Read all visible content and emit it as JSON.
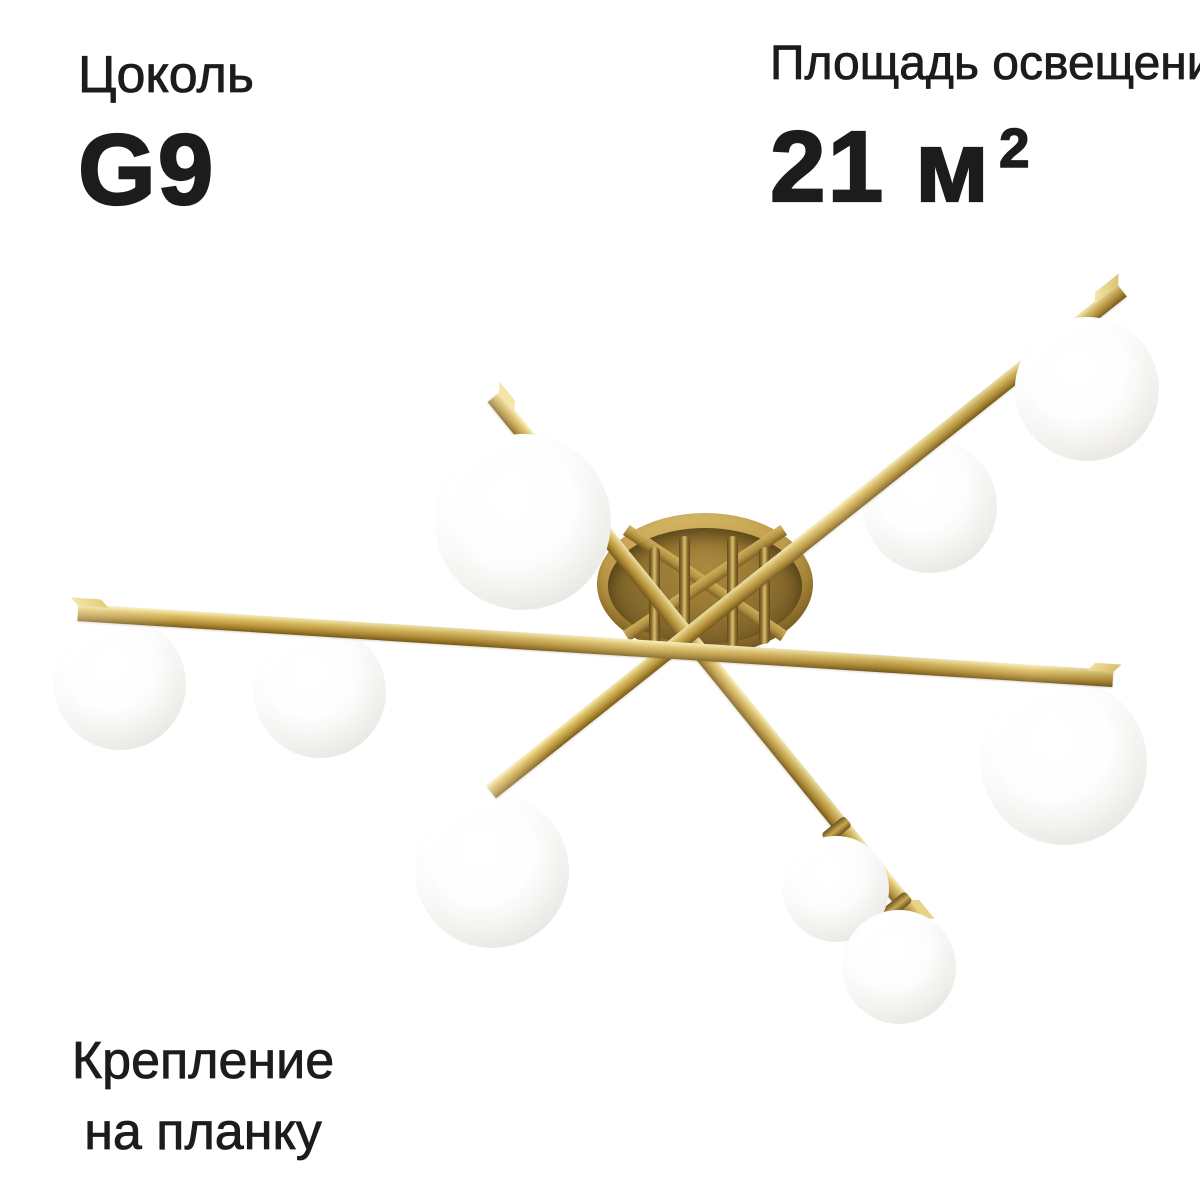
{
  "page": {
    "background": "#ffffff",
    "text_color": "#1c1c1c"
  },
  "annotations": {
    "socket": {
      "label": "Цоколь",
      "value": "G9"
    },
    "area": {
      "label": "Площадь освещения",
      "value_main": "21 м",
      "value_sup": "2"
    },
    "mounting": {
      "line1": "Крепление",
      "line2": "на планку"
    }
  },
  "product": {
    "description": "brass-ceiling-chandelier-with-white-glass-globes",
    "colors": {
      "brass_highlight": "#f7eebc",
      "brass_light": "#dcbd64",
      "brass_mid": "#c6a348",
      "brass_dark": "#8a6a22",
      "canopy_dark": "#66501f",
      "globe_white": "#ffffff",
      "globe_edge": "#e3e1dd"
    },
    "canopy": {
      "cx": 705,
      "cy": 584,
      "rx": 108,
      "ry": 71
    },
    "bars": [
      {
        "cls": "bar-c",
        "x": 494,
        "y": 397,
        "len": 676,
        "angle": 51.0,
        "h": 16,
        "z": 20
      },
      {
        "cls": "bar-b",
        "x": 491,
        "y": 792,
        "len": 806,
        "angle": -38.5,
        "h": 16,
        "z": 21
      },
      {
        "cls": "bar-a",
        "x": 78,
        "y": 612,
        "len": 1037,
        "angle": 3.65,
        "h": 17,
        "z": 22
      }
    ],
    "stems": [
      {
        "x": 830,
        "y": 815,
        "w": 13,
        "h": 30,
        "angle": 51,
        "z": 23
      },
      {
        "x": 890,
        "y": 890,
        "w": 13,
        "h": 32,
        "angle": 51,
        "z": 23
      }
    ],
    "globes": [
      {
        "cx": 120,
        "cy": 684,
        "r": 66,
        "z": 15
      },
      {
        "cx": 320,
        "cy": 692,
        "r": 66,
        "z": 15
      },
      {
        "cx": 523,
        "cy": 522,
        "r": 88,
        "z": 25
      },
      {
        "cx": 930,
        "cy": 506,
        "r": 67,
        "z": 15
      },
      {
        "cx": 1087,
        "cy": 389,
        "r": 72,
        "z": 25
      },
      {
        "cx": 1064,
        "cy": 762,
        "r": 83,
        "z": 15
      },
      {
        "cx": 492,
        "cy": 871,
        "r": 77,
        "z": 15
      },
      {
        "cx": 836,
        "cy": 889,
        "r": 53,
        "z": 24
      },
      {
        "cx": 899,
        "cy": 967,
        "r": 57,
        "z": 24
      }
    ]
  }
}
